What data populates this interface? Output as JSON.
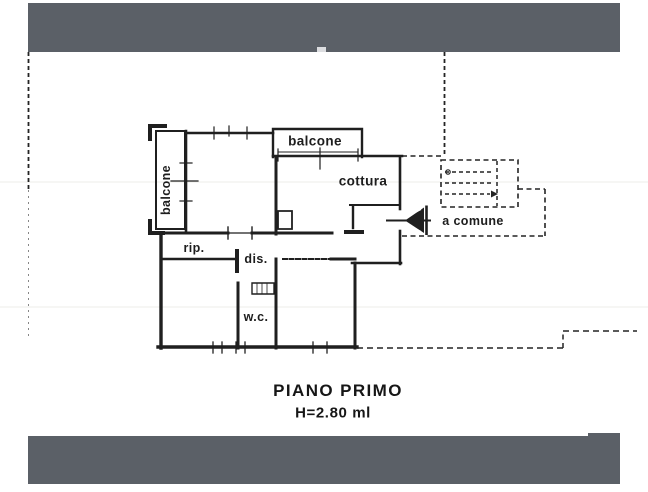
{
  "document": {
    "kind": "scanned floor plan drawing",
    "floor_caption": {
      "title": "PIANO PRIMO",
      "height_note": "H=2.80 ml"
    }
  },
  "floor_plan": {
    "labels": {
      "balcone_left": "balcone",
      "balcone_top": "balcone",
      "cottura": "cottura",
      "rip": "rip.",
      "dis": "dis.",
      "wc": "w.c.",
      "a_comune": "a comune"
    },
    "features": [
      "entrance-door-symbol",
      "common-stairwell-dashed",
      "balcony-left",
      "balcony-top",
      "property-boundary-dashed"
    ]
  },
  "colors": {
    "redaction_band": "#5b6067",
    "ink": "#1f1f1f",
    "faint_scan_line": "#ecece8",
    "paper": "#ffffff"
  }
}
